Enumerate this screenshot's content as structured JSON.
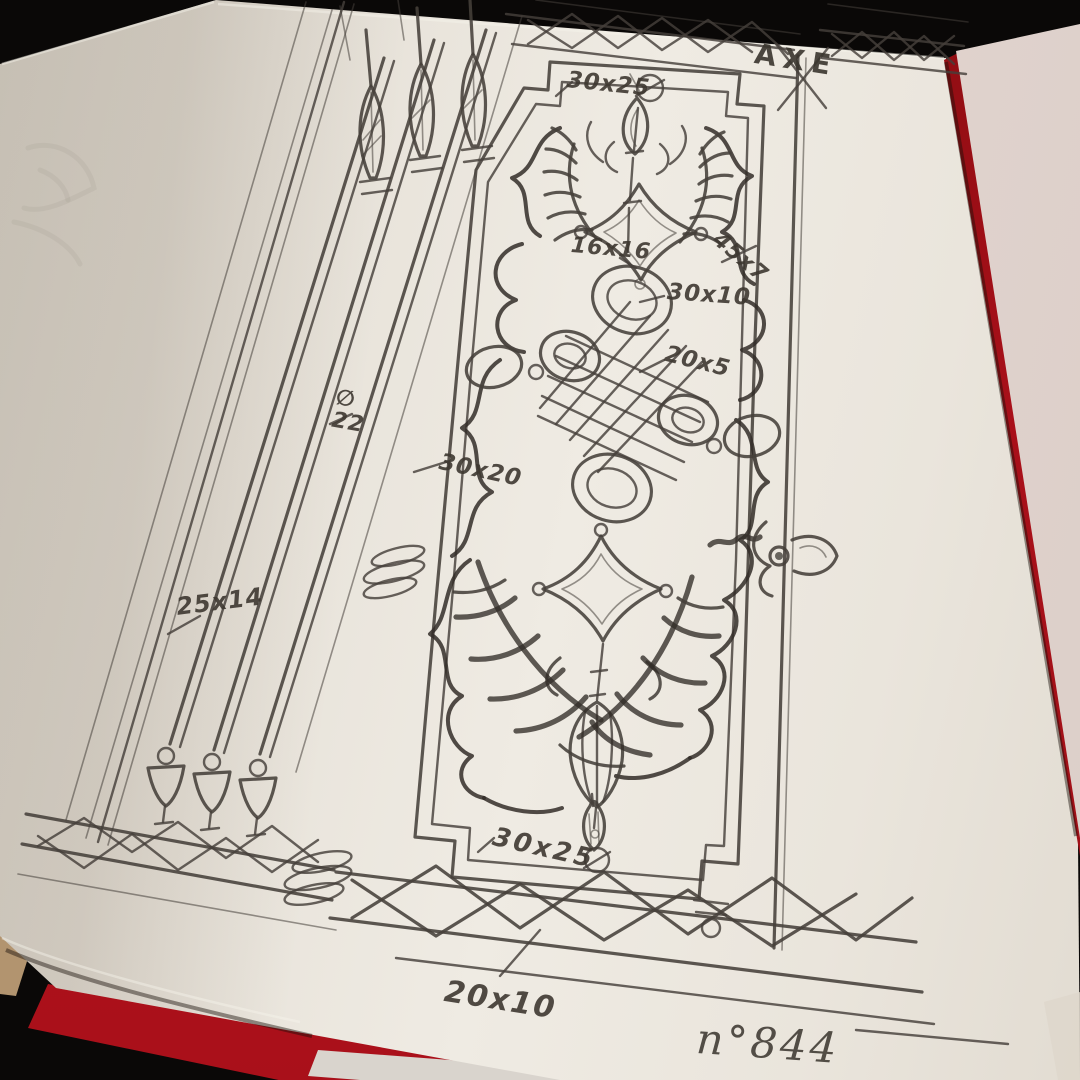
{
  "photo": {
    "axis_label": "AXE",
    "drawing_number": "n°844"
  },
  "dimension_labels": [
    {
      "name": "top-tab",
      "text": "30x25"
    },
    {
      "name": "boss-pair",
      "text": "16x16"
    },
    {
      "name": "right-frame",
      "text": "45x7"
    },
    {
      "name": "knot-loop",
      "text": "30x10"
    },
    {
      "name": "knot-bar",
      "text": "20x5"
    },
    {
      "name": "bar-diameter",
      "text": "∅ 22"
    },
    {
      "name": "panel-scroll",
      "text": "30x20"
    },
    {
      "name": "left-bars",
      "text": "25x14"
    },
    {
      "name": "bottom-tab",
      "text": "30x25"
    },
    {
      "name": "bottom-lattice",
      "text": "20x10"
    }
  ],
  "colors": {
    "background": "#0a0807",
    "cover_red": "#a9101a",
    "page": "#ece7df",
    "under_page": "#e2d4cf",
    "table_tan": "#b2946f",
    "paper_sliver": "#d9d4cd",
    "pencil": "#45403a",
    "pencil_dark": "#322d28"
  }
}
